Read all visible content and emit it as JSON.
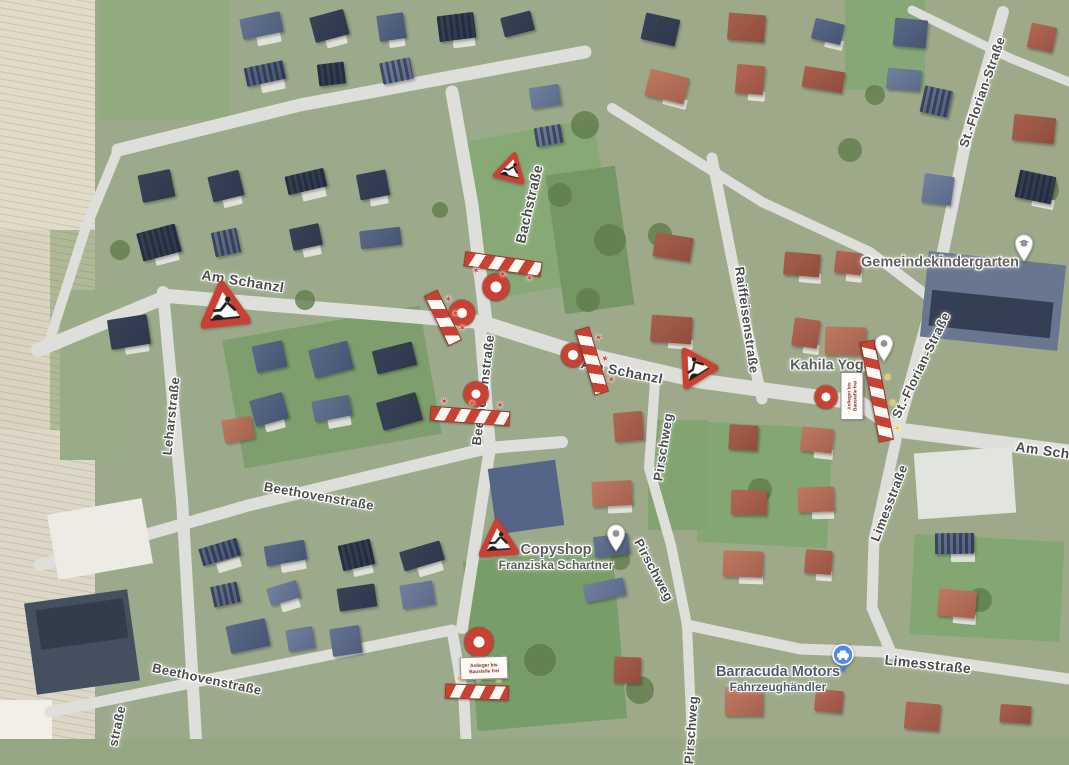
{
  "map": {
    "view": "satellite",
    "street_labels": [
      {
        "text": "Am Schanzl",
        "x": 243,
        "y": 281,
        "rot": 9,
        "size": 14
      },
      {
        "text": "Bachstraße",
        "x": 529,
        "y": 204,
        "rot": -77,
        "size": 14
      },
      {
        "text": "Am Schanzl",
        "x": 622,
        "y": 371,
        "rot": 11,
        "size": 14
      },
      {
        "text": "Am Schanzl",
        "x": 1057,
        "y": 452,
        "rot": 8,
        "size": 14
      },
      {
        "text": "Leharstraße",
        "x": 171,
        "y": 416,
        "rot": -84,
        "size": 13
      },
      {
        "text": "Beethovenstraße",
        "x": 319,
        "y": 496,
        "rot": 10,
        "size": 13
      },
      {
        "text": "Beethovenstraße",
        "x": 483,
        "y": 390,
        "rot": -83,
        "size": 13
      },
      {
        "text": "Beethovenstraße",
        "x": 207,
        "y": 679,
        "rot": 12,
        "size": 13
      },
      {
        "text": "straße",
        "x": 117,
        "y": 726,
        "rot": -78,
        "size": 13
      },
      {
        "text": "Raiffeisenstraße",
        "x": 747,
        "y": 320,
        "rot": 82,
        "size": 13
      },
      {
        "text": "Pirschweg",
        "x": 663,
        "y": 447,
        "rot": -81,
        "size": 13
      },
      {
        "text": "Pirschweg",
        "x": 654,
        "y": 570,
        "rot": 62,
        "size": 13
      },
      {
        "text": "Pirschweg",
        "x": 691,
        "y": 730,
        "rot": -86,
        "size": 13
      },
      {
        "text": "St.-Florian-Straße",
        "x": 982,
        "y": 92,
        "rot": -71,
        "size": 13
      },
      {
        "text": "St.-Florian-Straße",
        "x": 921,
        "y": 365,
        "rot": -64,
        "size": 13
      },
      {
        "text": "Limesstraße",
        "x": 889,
        "y": 503,
        "rot": -69,
        "size": 13
      },
      {
        "text": "Limesstraße",
        "x": 928,
        "y": 664,
        "rot": 6,
        "size": 14
      }
    ],
    "pois": [
      {
        "lines": [
          "Gemeindekindergarten"
        ],
        "x": 940,
        "y": 263,
        "pin_x": 1024,
        "pin_y": 262,
        "pin": "school",
        "tint": "#5d5d5d"
      },
      {
        "lines": [
          "Kahila Yoga"
        ],
        "x": 831,
        "y": 366,
        "pin_x": 884,
        "pin_y": 362,
        "pin": "dot",
        "tint": "#575757"
      },
      {
        "lines": [
          "Copyshop",
          "Franziska Schartner"
        ],
        "x": 556,
        "y": 557,
        "pin_x": 616,
        "pin_y": 552,
        "pin": "dot",
        "tint": "#575757"
      },
      {
        "lines": [
          "Barracuda Motors",
          "Fahrzeughändler"
        ],
        "x": 778,
        "y": 679,
        "pin_x": 843,
        "pin_y": 673,
        "pin": "car",
        "tint": "#45586e"
      }
    ],
    "construction": {
      "warning_triangles": [
        {
          "x": 224,
          "y": 306,
          "w": 50,
          "rot": -6
        },
        {
          "x": 511,
          "y": 169,
          "w": 32,
          "rot": 14
        },
        {
          "x": 694,
          "y": 366,
          "w": 40,
          "rot": -32
        },
        {
          "x": 498,
          "y": 540,
          "w": 40,
          "rot": -4
        }
      ],
      "road_closed_circles": [
        {
          "x": 496,
          "y": 287,
          "d": 27
        },
        {
          "x": 462,
          "y": 313,
          "d": 26
        },
        {
          "x": 573,
          "y": 355,
          "d": 24
        },
        {
          "x": 476,
          "y": 394,
          "d": 25
        },
        {
          "x": 826,
          "y": 397,
          "d": 23
        },
        {
          "x": 479,
          "y": 642,
          "d": 29
        }
      ],
      "barriers": [
        {
          "x": 503,
          "y": 264,
          "len": 76,
          "rot": 8,
          "lamps": "red",
          "side": "bottom"
        },
        {
          "x": 443,
          "y": 318,
          "len": 54,
          "rot": 64,
          "lamps": "red",
          "side": "top"
        },
        {
          "x": 592,
          "y": 361,
          "len": 66,
          "rot": 73,
          "lamps": "red",
          "side": "top"
        },
        {
          "x": 470,
          "y": 416,
          "len": 78,
          "rot": 4,
          "lamps": "red",
          "side": "top"
        },
        {
          "x": 877,
          "y": 391,
          "len": 100,
          "rot": 79,
          "lamps": "yellow",
          "side": "top"
        },
        {
          "x": 477,
          "y": 692,
          "len": 62,
          "rot": 2,
          "lamps": "yellow",
          "side": "top"
        }
      ],
      "access_signs": [
        {
          "x": 852,
          "y": 396,
          "rot": -90,
          "lines": [
            "Anlieger bis",
            "Baustelle frei"
          ]
        },
        {
          "x": 484,
          "y": 668,
          "rot": -2,
          "lines": [
            "Anlieger bis",
            "Baustelle frei"
          ]
        }
      ]
    },
    "colors": {
      "construction_red": "#d63726",
      "lamp_red": "#e23a24",
      "lamp_yellow": "#f2c200",
      "poi_pin_blue": "#4285f4",
      "street_label": "#474747"
    }
  }
}
